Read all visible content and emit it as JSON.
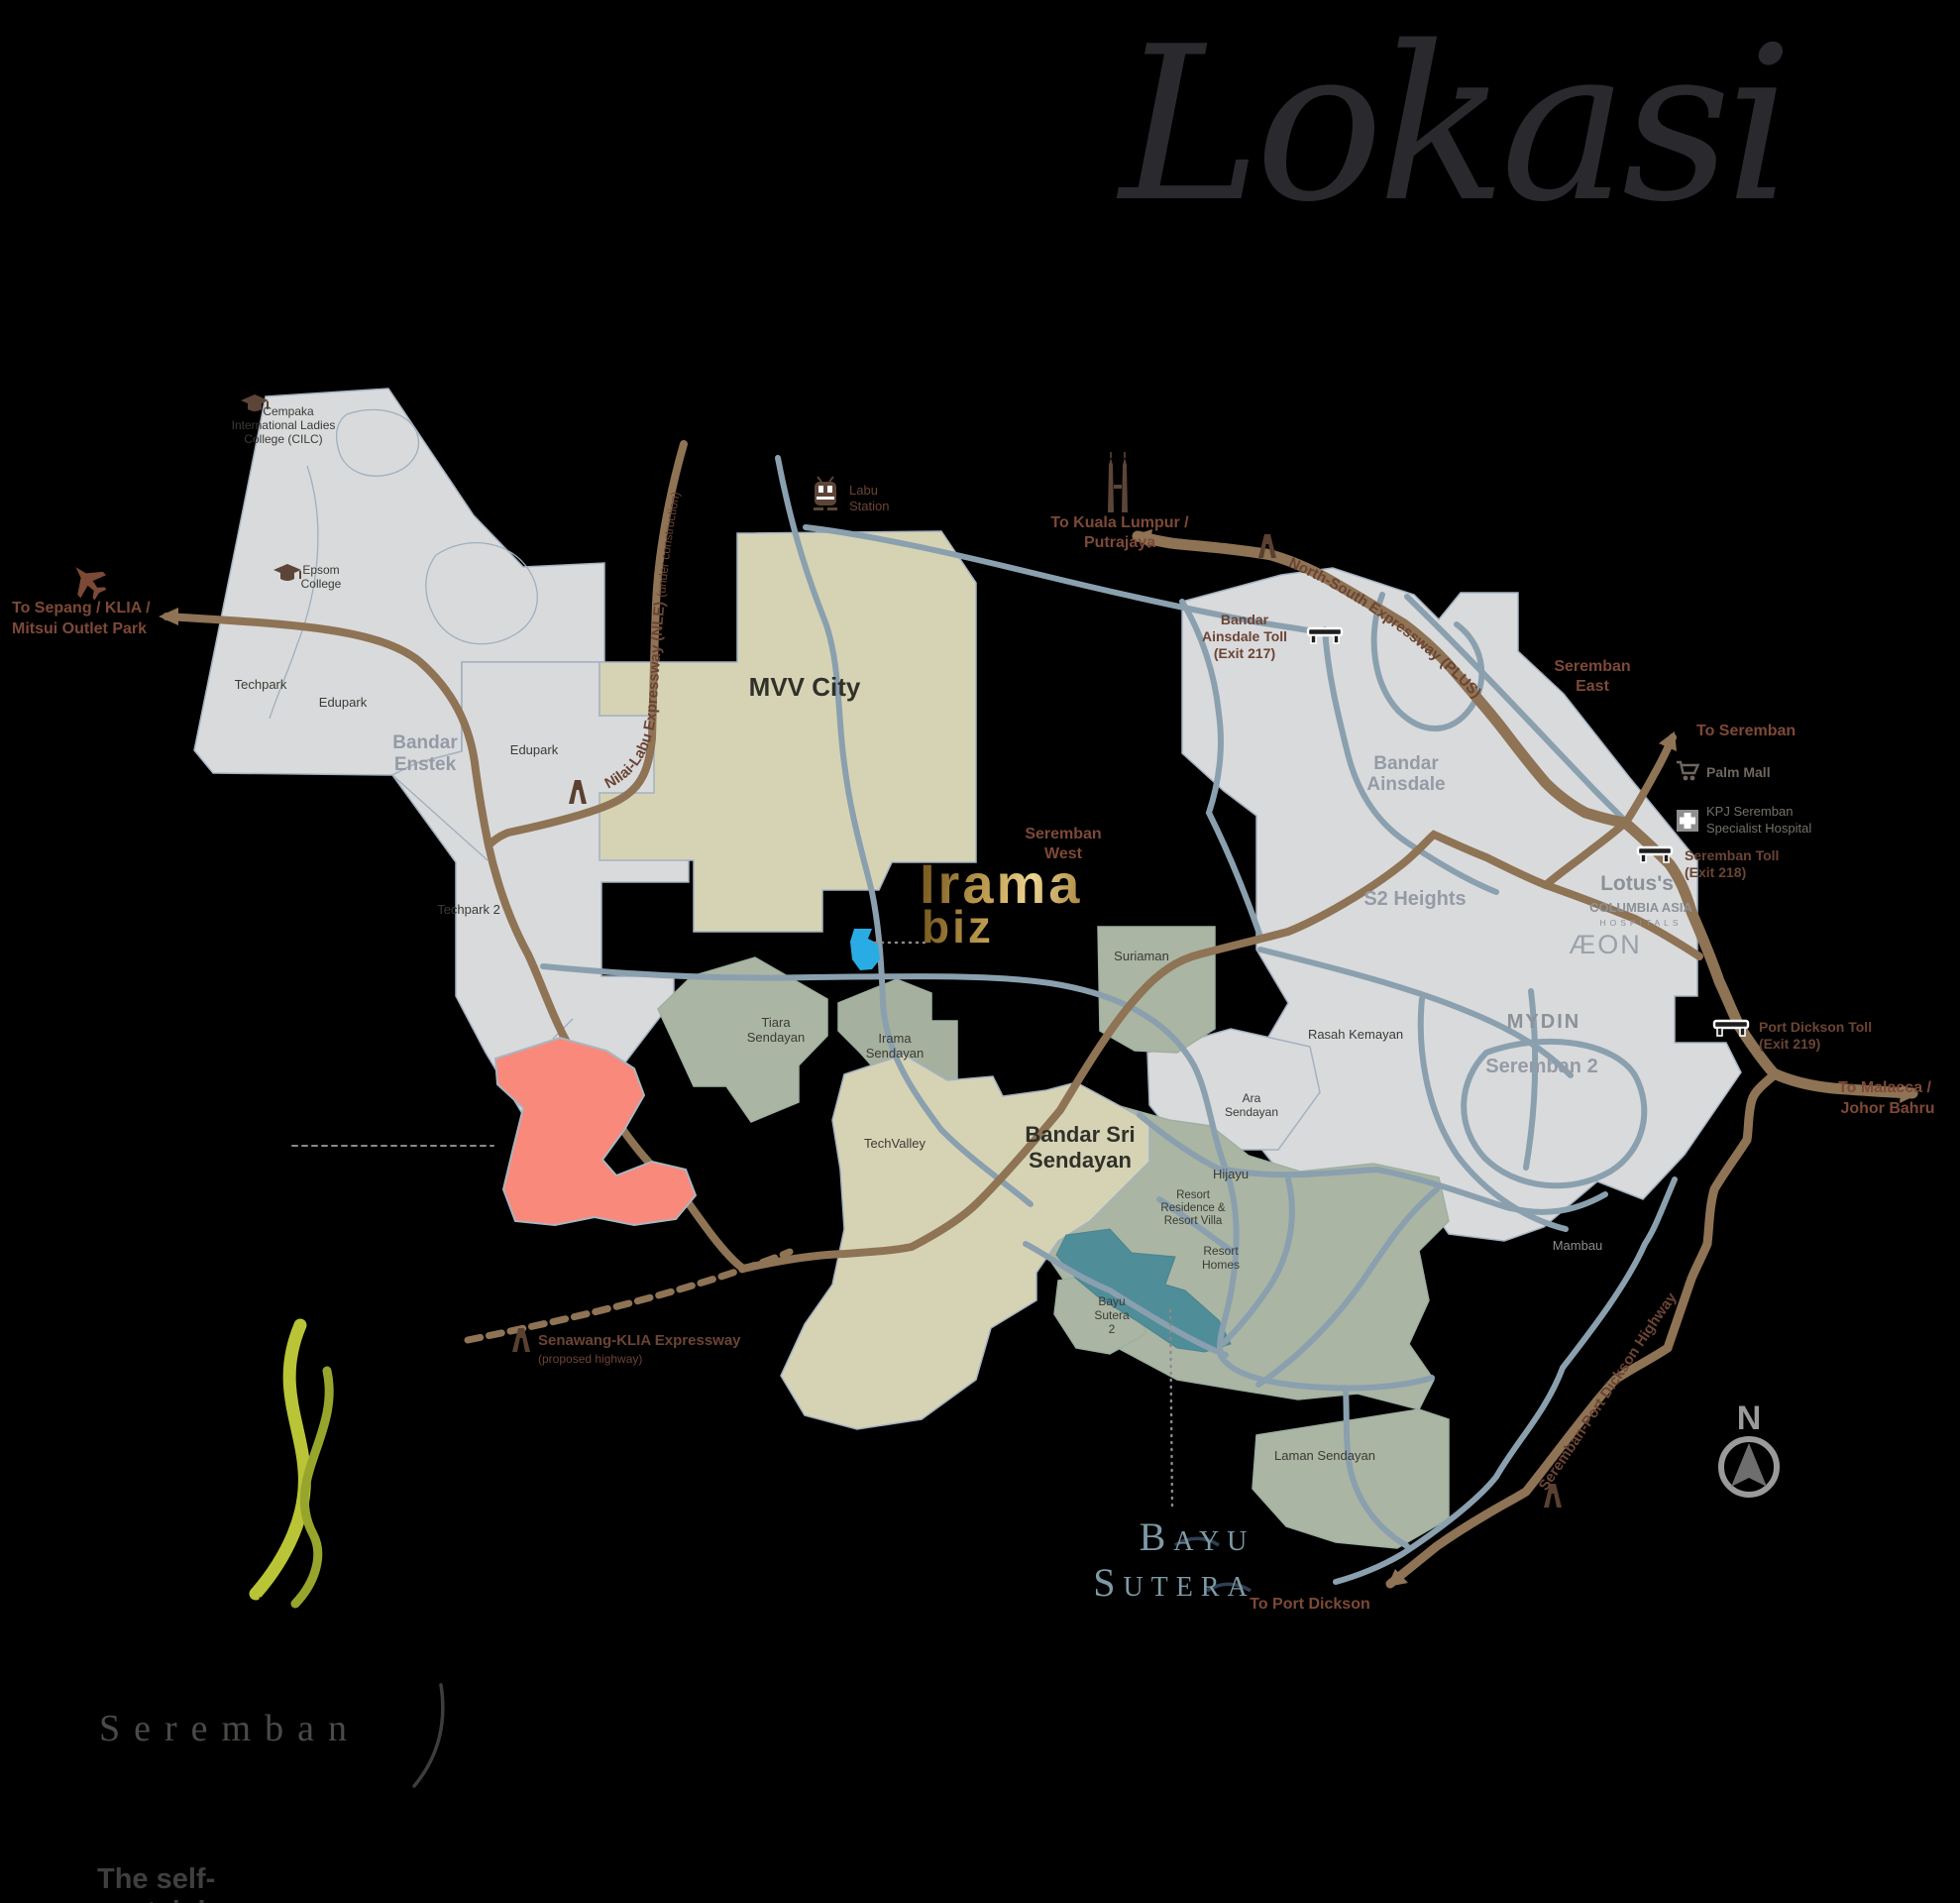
{
  "title": "Lokasi",
  "compass": "N",
  "logos": {
    "irama": {
      "top": "Irama",
      "bottom": "biz"
    },
    "bayu": {
      "top": "Bayu",
      "bottom": "Sutera"
    },
    "master": {
      "bandar": "Bandar",
      "sri": "Sri",
      "sendayan": "Sendayan",
      "city": "Seremban",
      "tagline": "The self-sustaining city"
    }
  },
  "map": {
    "areas": {
      "techpark": "Techpark",
      "edupark_west": "Edupark",
      "edupark_east": "Edupark",
      "techpark2": "Techpark 2",
      "bandar_enstek": [
        "Bandar",
        "Enstek"
      ],
      "mvv_city": "MVV City",
      "bandar_ainsdale": [
        "Bandar",
        "Ainsdale"
      ],
      "s2_heights": "S2 Heights",
      "seremban2": "Seremban 2",
      "rasah_kemayan": "Rasah Kemayan",
      "mambau": "Mambau",
      "seremban_west": [
        "Seremban",
        "West"
      ],
      "seremban_east": [
        "Seremban",
        "East"
      ],
      "suriaman": "Suriaman",
      "tiara_sendayan": [
        "Tiara",
        "Sendayan"
      ],
      "irama_sendayan": [
        "Irama",
        "Sendayan"
      ],
      "techvalley": "TechValley",
      "bandar_sri_sendayan": [
        "Bandar Sri",
        "Sendayan"
      ],
      "ara_sendayan": [
        "Ara",
        "Sendayan"
      ],
      "hijayu": "Hijayu",
      "resort_residence": [
        "Resort",
        "Residence &",
        "Resort Villa"
      ],
      "resort_homes": [
        "Resort",
        "Homes"
      ],
      "bayu_sutera2": [
        "Bayu",
        "Sutera",
        "2"
      ],
      "laman_sendayan": "Laman Sendayan"
    },
    "landmarks": {
      "cempaka": [
        "Cempaka",
        "International Ladies",
        "College (CILC)"
      ],
      "epsom": [
        "Epsom",
        "College"
      ],
      "labu_station": [
        "Labu",
        "Station"
      ],
      "palm_mall": "Palm Mall",
      "kpj": [
        "KPJ Seremban",
        "Specialist Hospital"
      ],
      "lotus": "Lotus's",
      "columbia": [
        "COLUMBIA ASIA",
        "HOSPITALS"
      ],
      "aeon": "ÆON",
      "mydin": "MYDIN"
    },
    "tolls": {
      "ainsdale": [
        "Bandar",
        "Ainsdale Toll",
        "(Exit 217)"
      ],
      "seremban": [
        "Seremban Toll",
        "(Exit 218)"
      ],
      "port_dickson": [
        "Port Dickson Toll",
        "(Exit 219)"
      ]
    },
    "directions": {
      "sepang": [
        "To Sepang / KLIA /",
        "Mitsui Outlet Park"
      ],
      "kl": [
        "To Kuala Lumpur /",
        "Putrajaya"
      ],
      "seremban": "To Seremban",
      "malacca": [
        "To Malacca /",
        "Johor Bahru"
      ],
      "port_dickson": "To Port Dickson"
    },
    "highways": {
      "nle": "Nilai-Labu Expressway (NLE)",
      "nle_note": " (under construction)",
      "plus": "North-South Expressway (PLUS)",
      "senawang": "Senawang-KLIA Expressway",
      "senawang_note": "(proposed highway)",
      "spd": "Seremban-Port Dickson Highway"
    }
  },
  "colors": {
    "background": "#000000",
    "region_gray": "#d9dadc",
    "region_beige": "#d6d3b5",
    "region_green": "#abb5a4",
    "region_teal": "#4f8d98",
    "highlight_salmon": "#f9897b",
    "lake_blue": "#29ace3",
    "road_brown": "#8e7354",
    "road_blue": "#8aa0ae",
    "label_brown": "#6b4434",
    "gold": "#c3a255",
    "logo_green": "#b9c437",
    "bayu_blue": "#7e99a5"
  }
}
